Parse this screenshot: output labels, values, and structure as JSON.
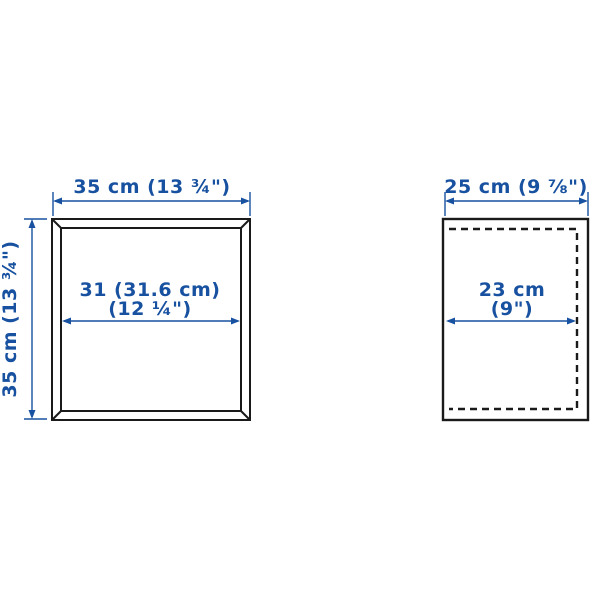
{
  "illustration": {
    "type": "product-dimension-diagram",
    "views": [
      "front",
      "side"
    ]
  },
  "colors": {
    "dimension_blue": "#1751A0",
    "outline_dark": "#1a1a1a",
    "background": "#ffffff"
  },
  "front_view": {
    "width_label": "35 cm (13 ¾\")",
    "height_label": "35 cm (13 ¾\")",
    "inner_width_line1": "31 (31.6 cm)",
    "inner_width_line2": "(12 ¼\")"
  },
  "side_view": {
    "depth_label": "25 cm (9 ⅞\")",
    "inner_depth_line1": "23 cm",
    "inner_depth_line2": "(9\")"
  }
}
